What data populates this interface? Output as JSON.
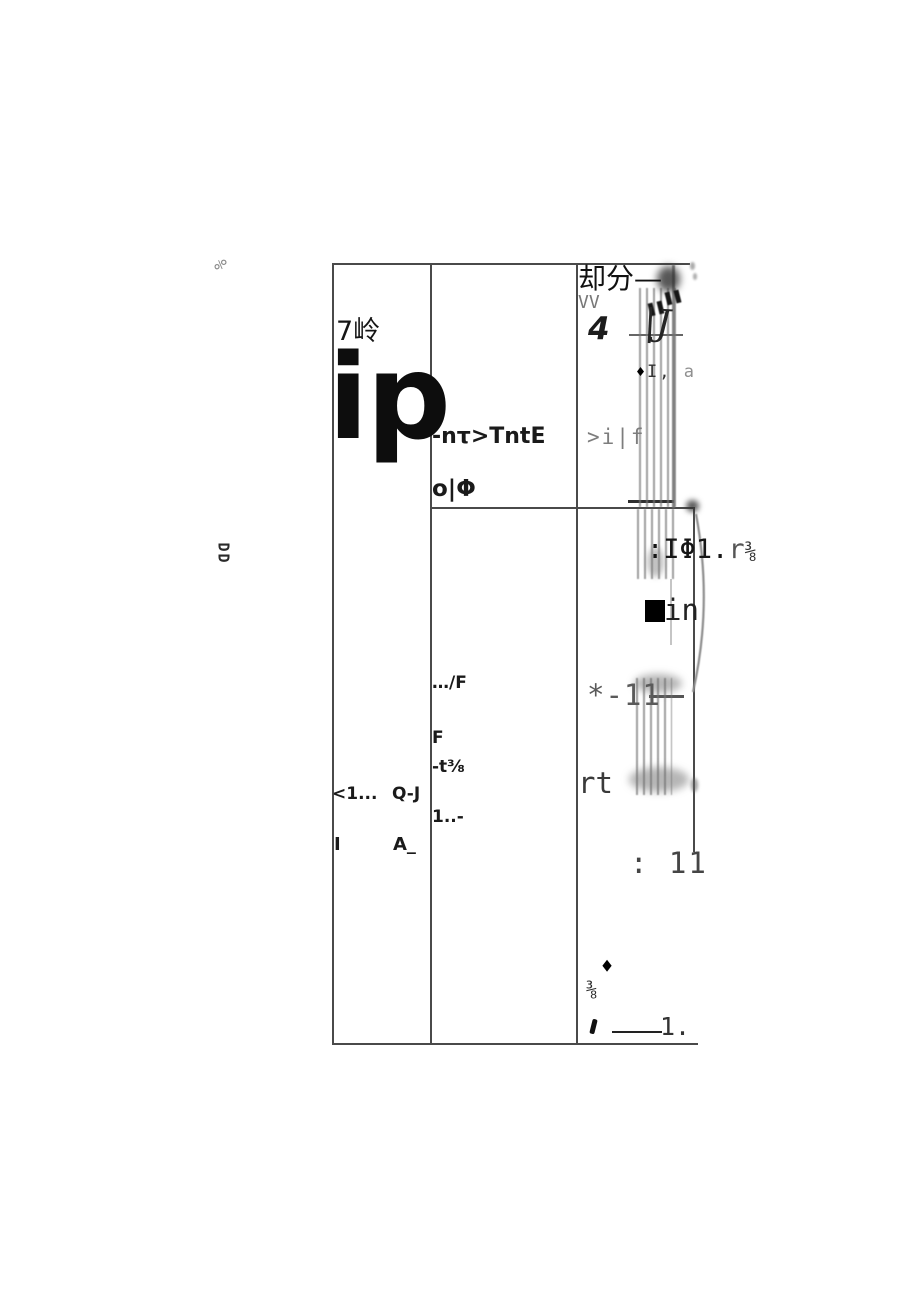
{
  "page": {
    "background": "#ffffff",
    "border_color": "#4a4a4a"
  },
  "margin_marks": {
    "top_mark": "%",
    "bottom_mark": "DD"
  },
  "table": {
    "column1": {
      "heading": "7岭",
      "big_label": "ip",
      "rows": [
        {
          "left": "<1...",
          "right": "Q-J"
        },
        {
          "left": "I",
          "right": "A_"
        }
      ]
    },
    "column2": {
      "line1": "-nτ>TntE",
      "line2": "o|Φ",
      "line3": "…/F",
      "line4": "F",
      "line5": "-t⅜",
      "line6": "1..-"
    },
    "column3": {
      "title": "却分—",
      "subtitle": "VV",
      "numeral": "4",
      "diamond_icon": "♦",
      "note_dark": "I,",
      "note_light": "a",
      "handwritten_mark": "|J",
      "fragment_gray": ">i|f",
      "phi_line_main": ":IΦ1.",
      "phi_line_r": "r",
      "phi_line_frac": "⅜",
      "in_label": "in",
      "star_fragment": "*-11",
      "rt_fragment": "rt",
      "colon_eleven": ": 11",
      "diamond2_icon": "♦",
      "fraction_mark": "⅜",
      "number_label": "1."
    }
  }
}
